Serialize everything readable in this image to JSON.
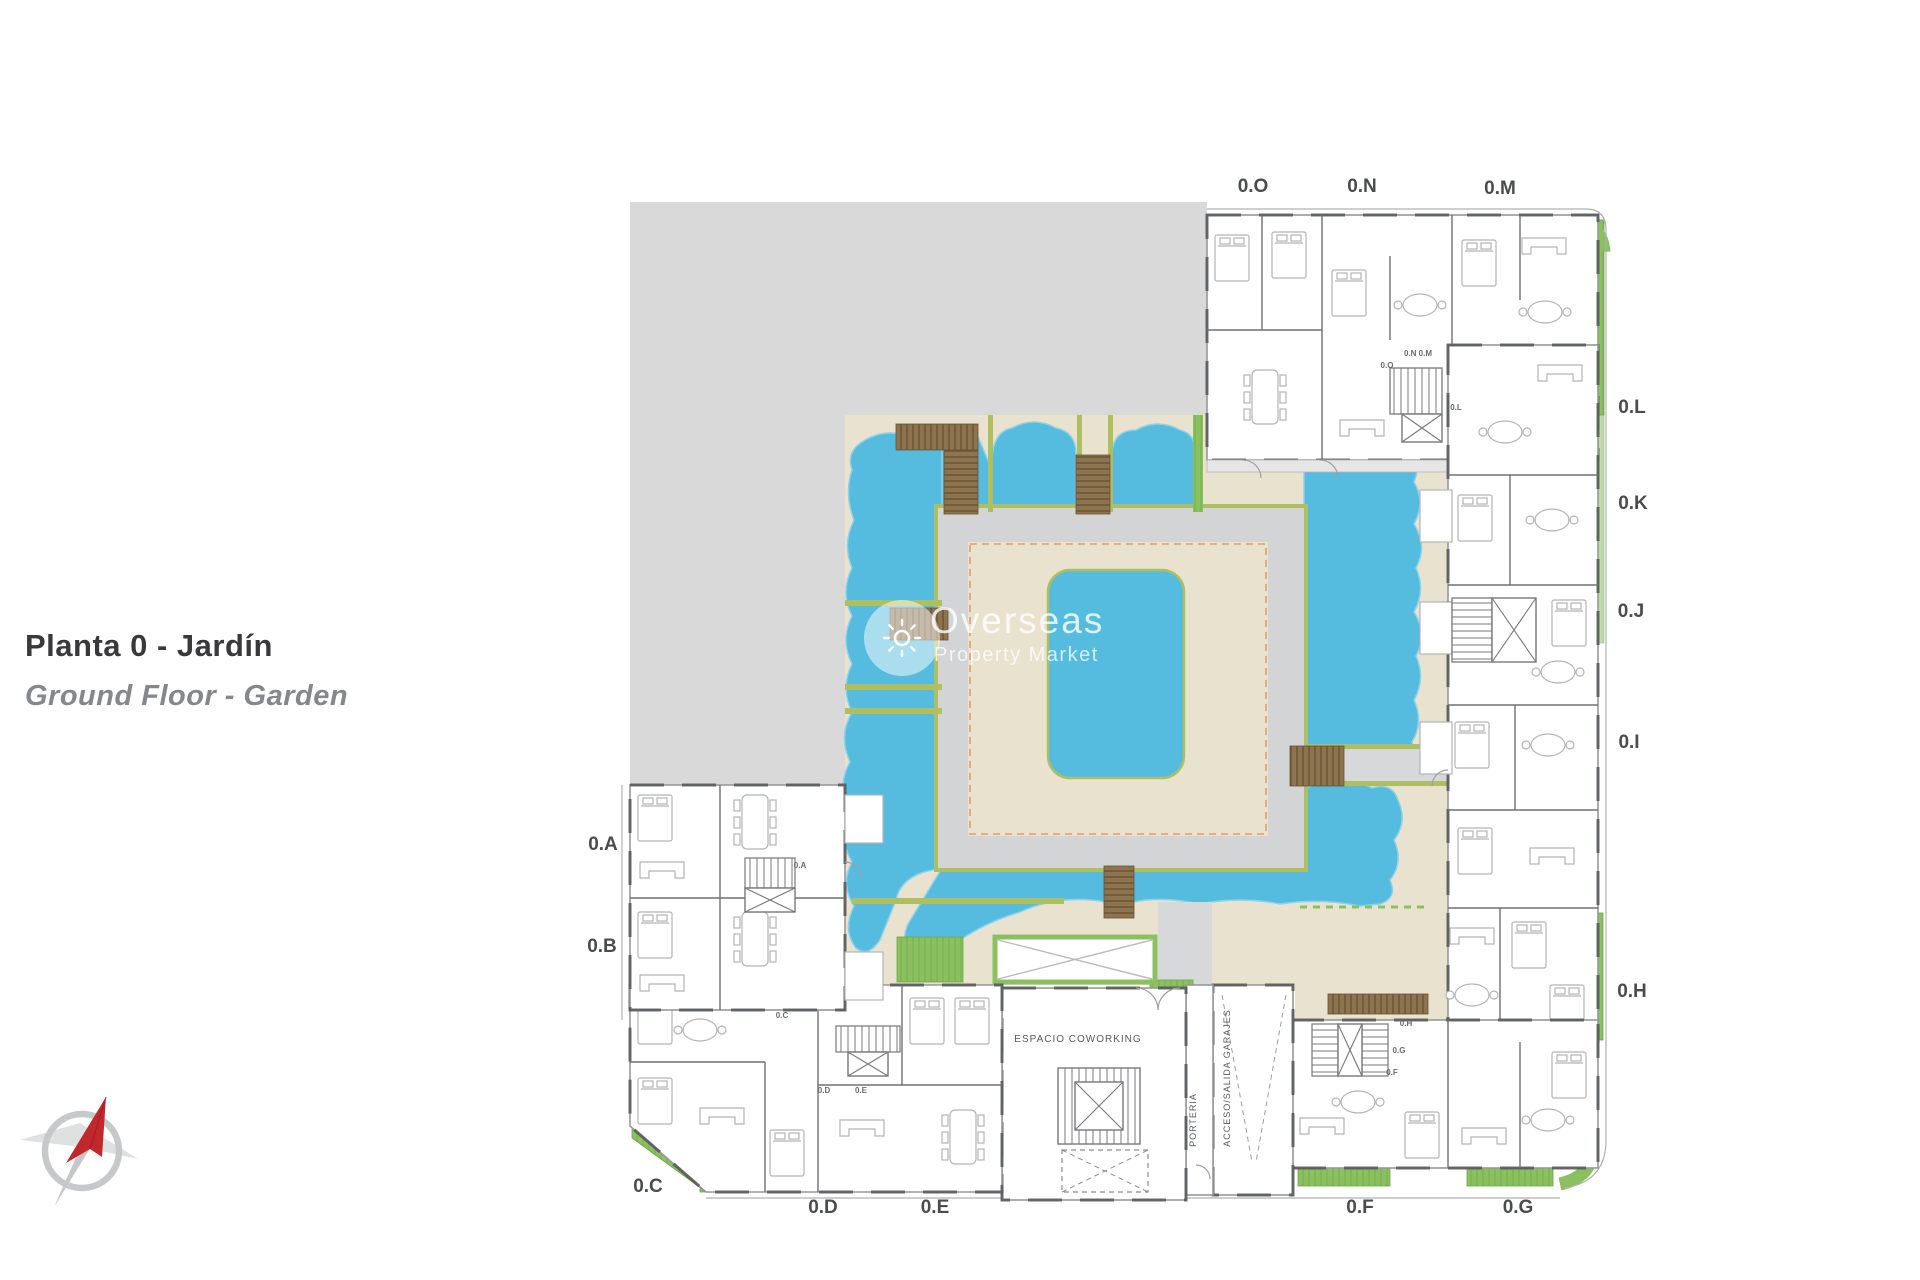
{
  "title": {
    "primary": "Planta 0 - Jardín",
    "secondary": "Ground Floor - Garden"
  },
  "watermark": {
    "brand": "Overseas",
    "tagline": "Property Market"
  },
  "plan": {
    "unit_labels": [
      {
        "text": "0.O"
      },
      {
        "text": "0.N"
      },
      {
        "text": "0.M"
      },
      {
        "text": "0.L"
      },
      {
        "text": "0.K"
      },
      {
        "text": "0.J"
      },
      {
        "text": "0.I"
      },
      {
        "text": "0.H"
      },
      {
        "text": "0.G"
      },
      {
        "text": "0.F"
      },
      {
        "text": "0.E"
      },
      {
        "text": "0.D"
      },
      {
        "text": "0.C"
      },
      {
        "text": "0.B"
      },
      {
        "text": "0.A"
      }
    ],
    "room_labels": {
      "coworking": "ESPACIO COWORKING",
      "concierge": "PORTERIA",
      "garage": "ACCESO/SALIDA GARAJES"
    },
    "door_tags": [
      {
        "text": "0.O"
      },
      {
        "text": "0.N 0.M"
      },
      {
        "text": "0.L"
      },
      {
        "text": "0.A"
      },
      {
        "text": "0.C"
      },
      {
        "text": "0.D"
      },
      {
        "text": "0.E"
      },
      {
        "text": "0.F"
      },
      {
        "text": "0.G"
      },
      {
        "text": "0.H"
      }
    ],
    "colors": {
      "pool": "#55bcdf",
      "pool_rim": "#8ed2e6",
      "terrace": "#e9e2cf",
      "lawn": "#8ac05f",
      "deck": "#8d7450",
      "platform": "#d3d4d5",
      "site_block": "#d9d9da",
      "walk_edge": "#aebf62",
      "accent_dash": "#df9e66",
      "wall": "#555658",
      "label": "#4b4c4e",
      "compass_red": "#c1282c"
    }
  }
}
